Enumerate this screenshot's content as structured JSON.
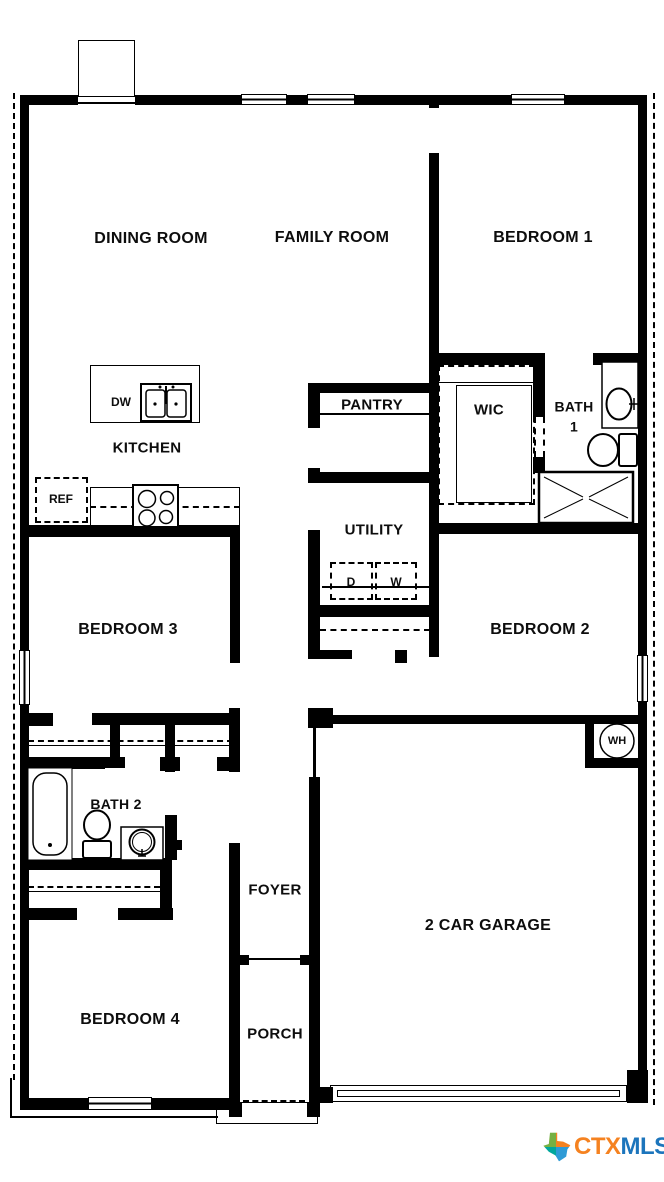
{
  "page": {
    "background": "#ffffff",
    "wall_color": "#000000"
  },
  "floorplan": {
    "room_labels": [
      {
        "id": "dining-room",
        "lines": [
          "DINING ROOM"
        ],
        "cx": 151,
        "cy": 239,
        "fs": 16
      },
      {
        "id": "family-room",
        "lines": [
          "FAMILY ROOM"
        ],
        "cx": 332,
        "cy": 238,
        "fs": 16
      },
      {
        "id": "bedroom-1",
        "lines": [
          "BEDROOM 1"
        ],
        "cx": 543,
        "cy": 238,
        "fs": 16
      },
      {
        "id": "pantry",
        "lines": [
          "PANTRY"
        ],
        "cx": 372,
        "cy": 405,
        "fs": 15
      },
      {
        "id": "wic",
        "lines": [
          "WIC"
        ],
        "cx": 489,
        "cy": 410,
        "fs": 15
      },
      {
        "id": "bath-1",
        "lines": [
          "BATH",
          "1"
        ],
        "cx": 574,
        "cy": 417,
        "fs": 14
      },
      {
        "id": "kitchen",
        "lines": [
          "KITCHEN"
        ],
        "cx": 147,
        "cy": 448,
        "fs": 15
      },
      {
        "id": "utility",
        "lines": [
          "UTILITY"
        ],
        "cx": 374,
        "cy": 530,
        "fs": 15
      },
      {
        "id": "bedroom-3",
        "lines": [
          "BEDROOM 3"
        ],
        "cx": 128,
        "cy": 630,
        "fs": 16
      },
      {
        "id": "bedroom-2",
        "lines": [
          "BEDROOM 2"
        ],
        "cx": 540,
        "cy": 630,
        "fs": 16
      },
      {
        "id": "bath-2",
        "lines": [
          "BATH 2"
        ],
        "cx": 116,
        "cy": 805,
        "fs": 14
      },
      {
        "id": "foyer",
        "lines": [
          "FOYER"
        ],
        "cx": 275,
        "cy": 890,
        "fs": 15
      },
      {
        "id": "garage",
        "lines": [
          "2 CAR GARAGE"
        ],
        "cx": 488,
        "cy": 926,
        "fs": 16
      },
      {
        "id": "bedroom-4",
        "lines": [
          "BEDROOM 4"
        ],
        "cx": 130,
        "cy": 1020,
        "fs": 16
      },
      {
        "id": "porch",
        "lines": [
          "PORCH"
        ],
        "cx": 275,
        "cy": 1034,
        "fs": 15
      }
    ],
    "fixture_labels": [
      {
        "id": "dishwasher",
        "text": "DW",
        "cx": 121,
        "cy": 402,
        "fs": 12
      },
      {
        "id": "refrigerator",
        "text": "REF",
        "cx": 61,
        "cy": 499,
        "fs": 12
      },
      {
        "id": "dryer",
        "text": "D",
        "cx": 351,
        "cy": 582,
        "fs": 12
      },
      {
        "id": "washer",
        "text": "W",
        "cx": 396,
        "cy": 582,
        "fs": 12
      },
      {
        "id": "water-heater",
        "text": "WH",
        "cx": 617,
        "cy": 741,
        "fs": 11
      }
    ],
    "logo": {
      "prefix": "CTX",
      "suffix": "MLS",
      "prefix_color": "#F58220",
      "suffix_color": "#1C75BC",
      "icon_colors": [
        "#76B043",
        "#F58220",
        "#00A79D",
        "#2E9BD6"
      ]
    }
  }
}
